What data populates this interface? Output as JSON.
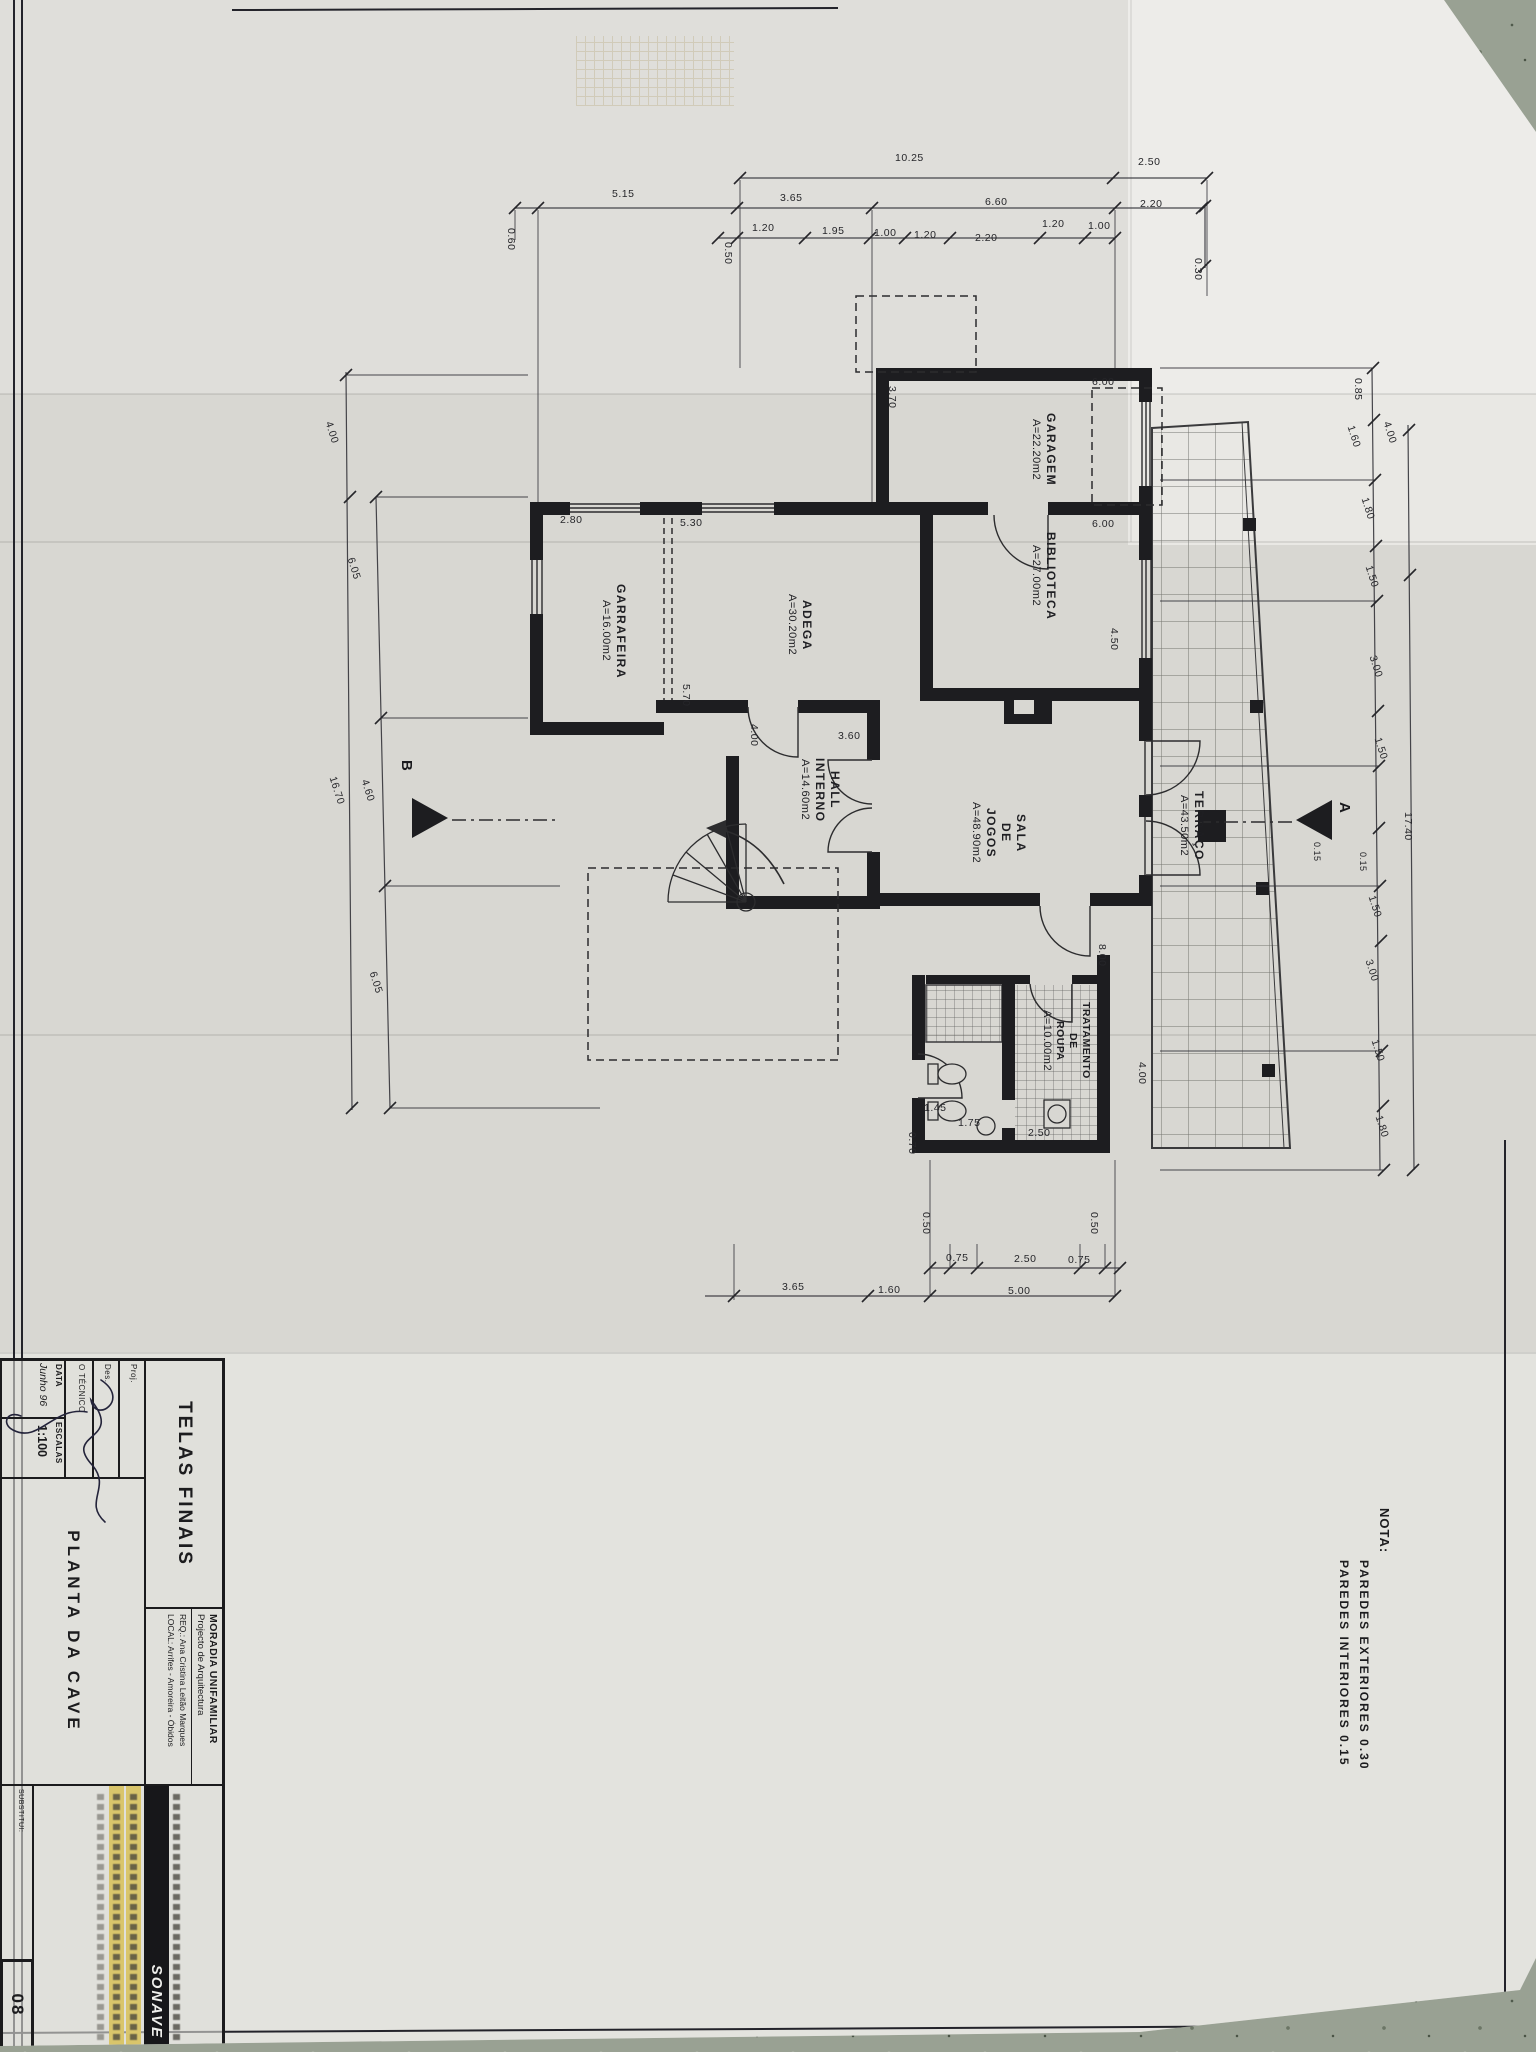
{
  "colors": {
    "paper": "#d8d7d2",
    "ink": "#1d1d20",
    "floor": "#99a193",
    "highlight": "#d9c56b"
  },
  "note": {
    "title": "NOTA:",
    "lines": [
      "PAREDES  EXTERIORES  0.30",
      "PAREDES  INTERIORES  0.15"
    ]
  },
  "markers": {
    "a": "A",
    "b": "B"
  },
  "rooms": {
    "garagem": {
      "name": "GARAGEM",
      "area": "A=22.20m2"
    },
    "biblioteca": {
      "name": "BIBLIOTECA",
      "area": "A=27.00m2"
    },
    "adega": {
      "name": "ADEGA",
      "area": "A=30.20m2"
    },
    "garrafeira": {
      "name": "GARRAFEIRA",
      "area": "A=16.00m2"
    },
    "hall": {
      "l1": "HALL",
      "l2": "INTERNO",
      "area": "A=14.60m2"
    },
    "sala": {
      "l1": "SALA",
      "l2": "DE",
      "l3": "JOGOS",
      "area": "A=48.90m2"
    },
    "terraco": {
      "name": "TERRAÇO",
      "area": "A=43.50m2"
    },
    "tratamento": {
      "l1": "TRATAMENTO",
      "l2": "DE",
      "l3": "ROUPA",
      "area": "A=10.00m2"
    }
  },
  "dims": {
    "d01": "10.25",
    "d02": "2.50",
    "d03": "5.15",
    "d04": "3.65",
    "d05": "6.60",
    "d06": "2.20",
    "d07": "1.20",
    "d08": "1.95",
    "d09": "1.00",
    "d10": "1.20",
    "d11": "2.20",
    "d12": "1.20",
    "d13": "1.00",
    "d14": "0.50",
    "d15": "0.60",
    "d16": "0.30",
    "d17": "0.50",
    "d18": "0.75",
    "d19": "2.50",
    "d20": "0.75",
    "d21": "0.50",
    "d22": "3.65",
    "d23": "1.60",
    "d24": "5.00",
    "d25": "4.00",
    "d26": "6.05",
    "d27": "4.60",
    "d28": "6.05",
    "d29": "16.70",
    "d30": "4.00",
    "d31": "0.85",
    "d32": "1.60",
    "d33": "1.80",
    "d34": "1.50",
    "d35": "3.00",
    "d36": "1.50",
    "d37": "0.15",
    "d38": "0.15",
    "d39": "17.40",
    "d40": "1.50",
    "d41": "3.00",
    "d42": "1.50",
    "d43": "1.80",
    "d44": "3.70",
    "d45": "6.00",
    "d46": "6.00",
    "d47": "2.80",
    "d48": "5.30",
    "d49": "5.70",
    "d50": "4.00",
    "d51": "3.60",
    "d52": "4.50",
    "d53": "8.00",
    "d54": "1.45",
    "d55": "1.75",
    "d56": "0.70",
    "d57": "2.50",
    "d58": "4.00"
  },
  "title_block": {
    "telas": "TELAS FINAIS",
    "moradia": "MORADIA UNIFAMILIAR",
    "projecto": "Projecto de Arquitectura",
    "req": "REQ.:  Ana Cristina Leitão Marques",
    "local": "LOCAL:  Arrifes - Amoreira - Óbidos",
    "proj_label": "Proj.",
    "des_label": "Des.",
    "tecnico_label": "O TÉCNICO",
    "data_label": "DATA",
    "data_value": "Junho 96",
    "escalas_label": "ESCALAS",
    "escalas_value": "1:100",
    "drawing_title": "PLANTA  DA  CAVE",
    "company": "SONAVE",
    "substitui_label": "SUBSTITUI:",
    "sheet_number": "08"
  }
}
